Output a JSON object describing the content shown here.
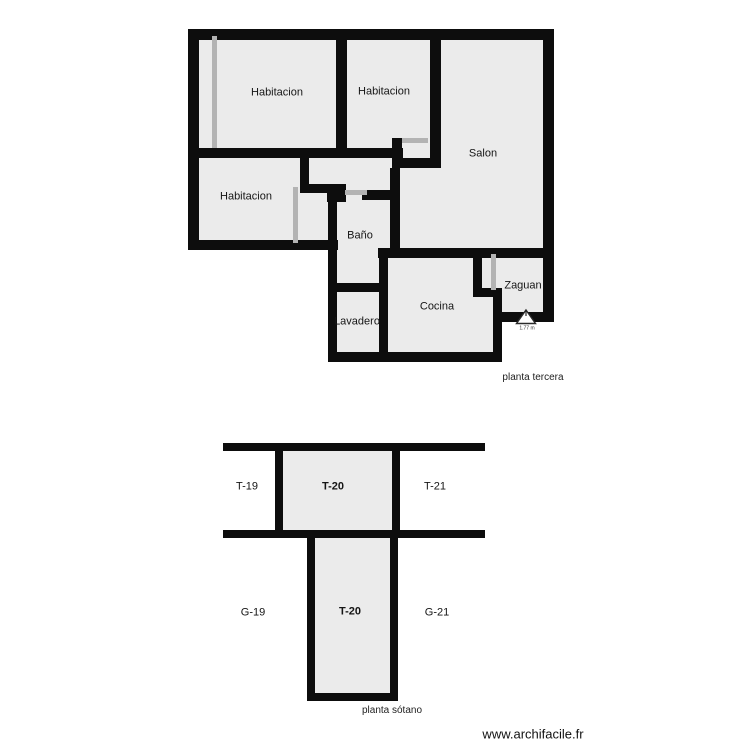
{
  "colors": {
    "wall": "#0d0d0d",
    "room_fill": "#ebebeb",
    "door_marker": "#b3b3b3",
    "background": "#ffffff"
  },
  "floors": {
    "tercera": {
      "caption": "planta tercera",
      "rooms": {
        "hab1": "Habitacion",
        "hab2": "Habitacion",
        "hab3": "Habitacion",
        "salon": "Salon",
        "bano": "Baño",
        "lavadero": "Lavadero",
        "cocina": "Cocina",
        "zaguan": "Zaguan"
      },
      "marker_text": "1.77 m"
    },
    "sotano": {
      "caption": "planta sótano",
      "labels": {
        "t19": "T-19",
        "t20_top": "T-20",
        "t21": "T-21",
        "g19": "G-19",
        "t20_bottom": "T-20",
        "g21": "G-21"
      }
    }
  },
  "footer": {
    "website": "www.archifacile.fr"
  }
}
